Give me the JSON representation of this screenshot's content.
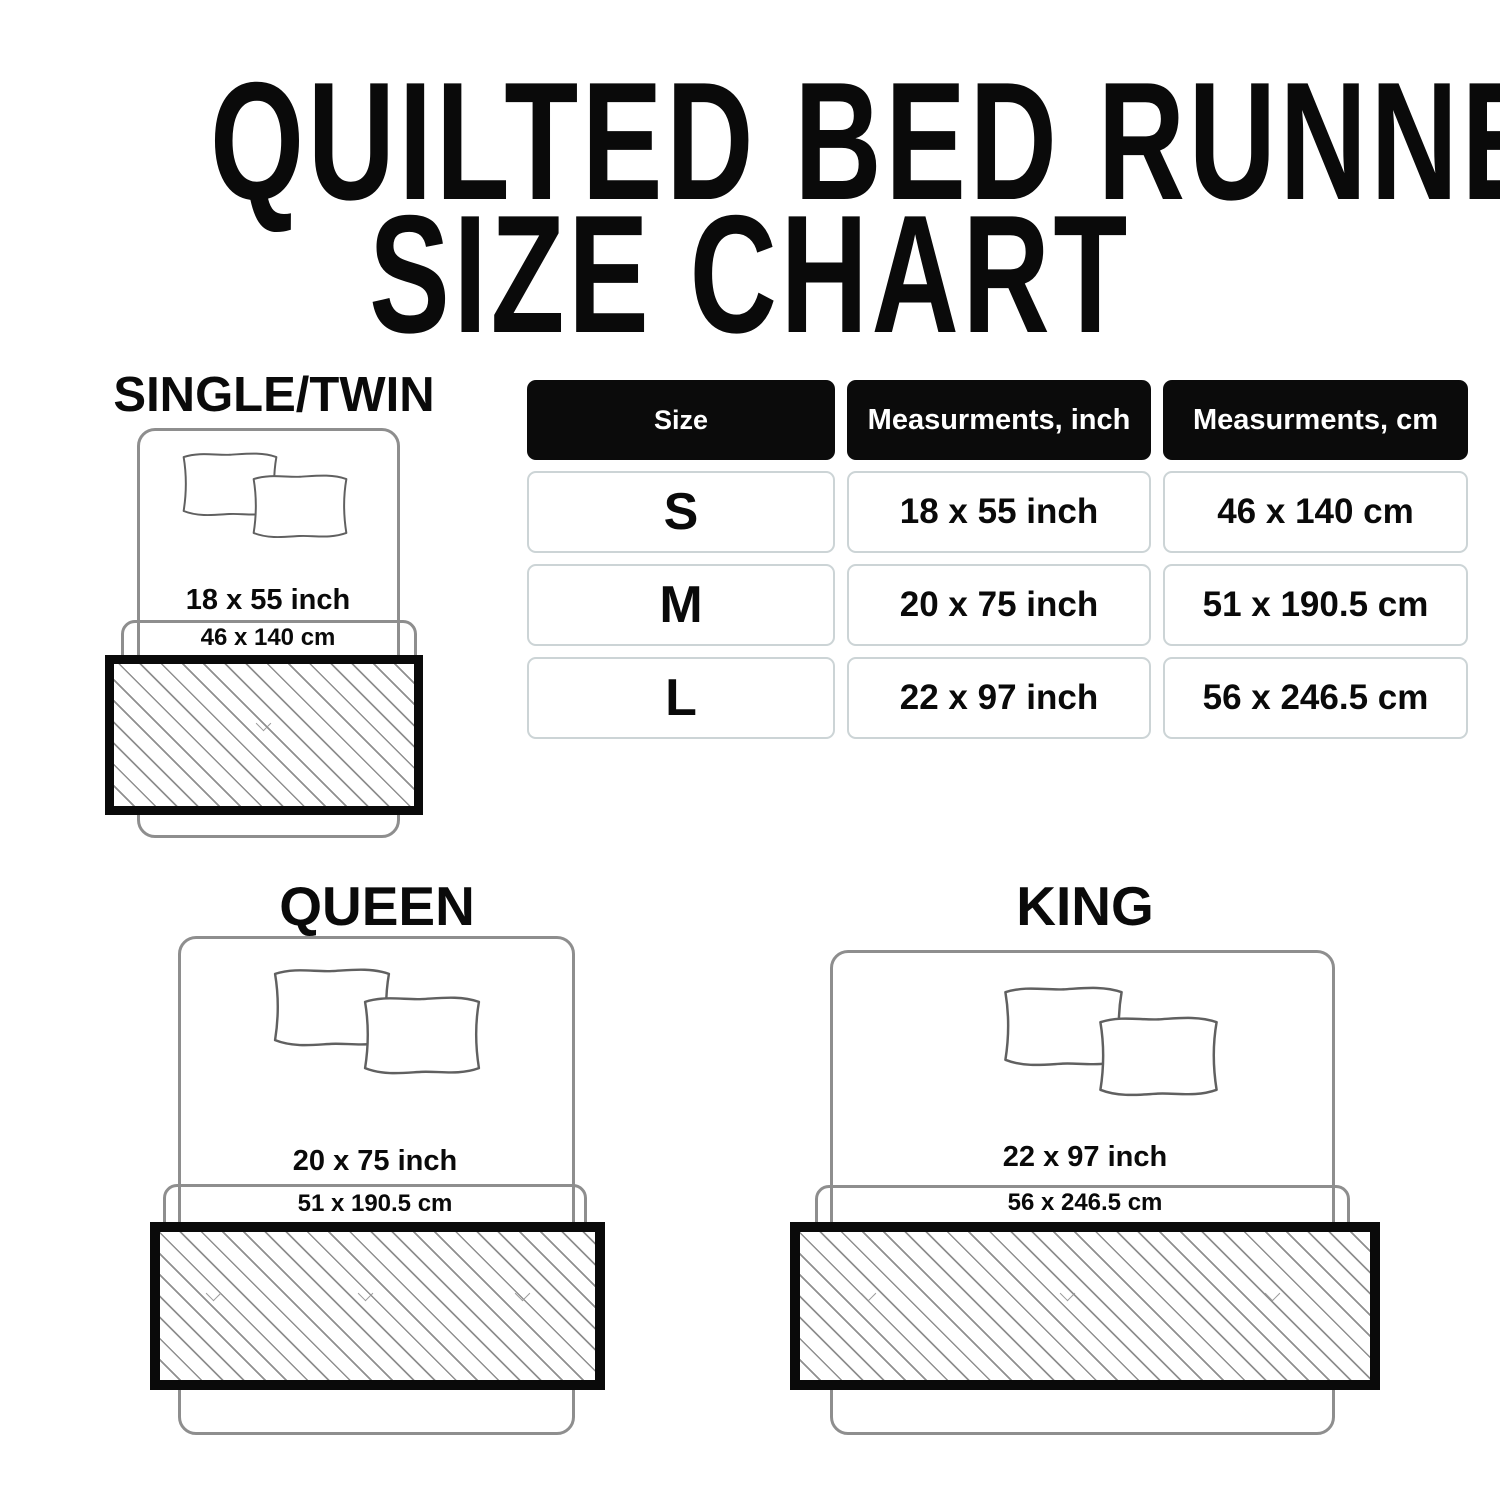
{
  "title": {
    "line1": "QUILTED BED RUNNER",
    "line2": "SIZE CHART"
  },
  "size_table": {
    "headers": [
      "Size",
      "Measurments, inch",
      "Measurments, cm"
    ],
    "rows": [
      {
        "size": "S",
        "inch": "18 x 55 inch",
        "cm": "46 x 140 cm"
      },
      {
        "size": "M",
        "inch": "20 x 75 inch",
        "cm": "51 x 190.5 cm"
      },
      {
        "size": "L",
        "inch": "22 x 97 inch",
        "cm": "56 x 246.5 cm"
      }
    ]
  },
  "diagrams": [
    {
      "label": "SINGLE/TWIN",
      "inch": "18 x 55 inch",
      "cm": "46 x 140 cm"
    },
    {
      "label": "QUEEN",
      "inch": "20 x 75 inch",
      "cm": "51 x 190.5 cm"
    },
    {
      "label": "KING",
      "inch": "22 x 97 inch",
      "cm": "56 x 246.5 cm"
    }
  ],
  "colors": {
    "text": "#0a0a0a",
    "table_header_bg": "#0b0b0b",
    "table_header_text": "#ffffff",
    "table_cell_border": "#ccd4d6",
    "bed_outline": "#8e8e8e",
    "pillow_outline": "#606060",
    "runner_border": "#0a0a0a",
    "hatch_line": "#8f8f8f"
  }
}
